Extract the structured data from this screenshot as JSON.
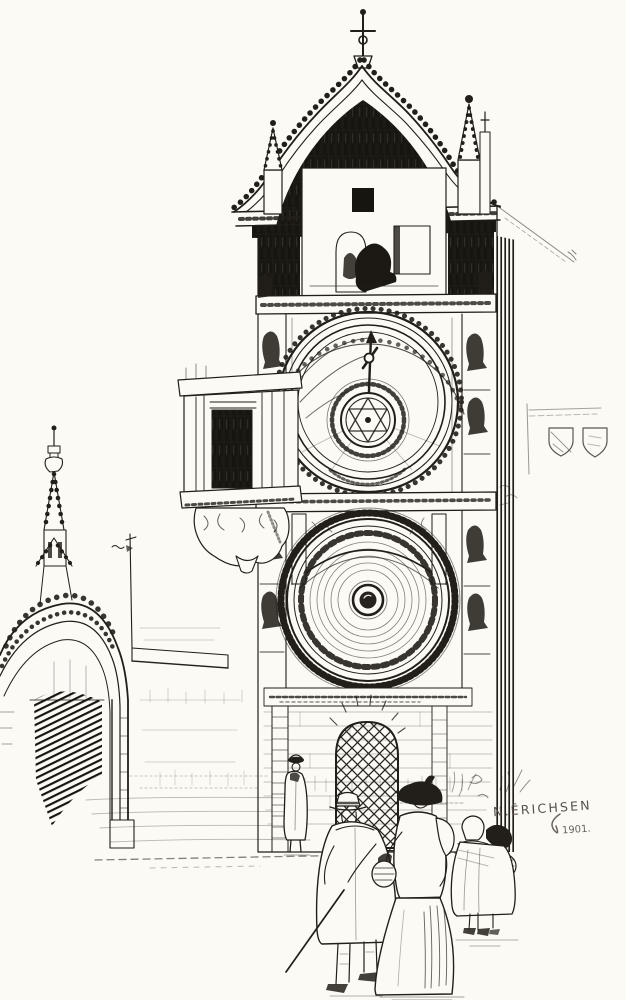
{
  "artwork": {
    "medium": "pen-and-ink illustration",
    "subject": "Gothic astronomical clock tower with two large dials, side portal arch, and onlookers in the square",
    "signature": "N.ĒRICHSEN",
    "date_inscription": "1901.",
    "palette": {
      "ink": "#221e19",
      "paper": "#fbfaf5",
      "faint_sketch": "#8a847c"
    }
  }
}
